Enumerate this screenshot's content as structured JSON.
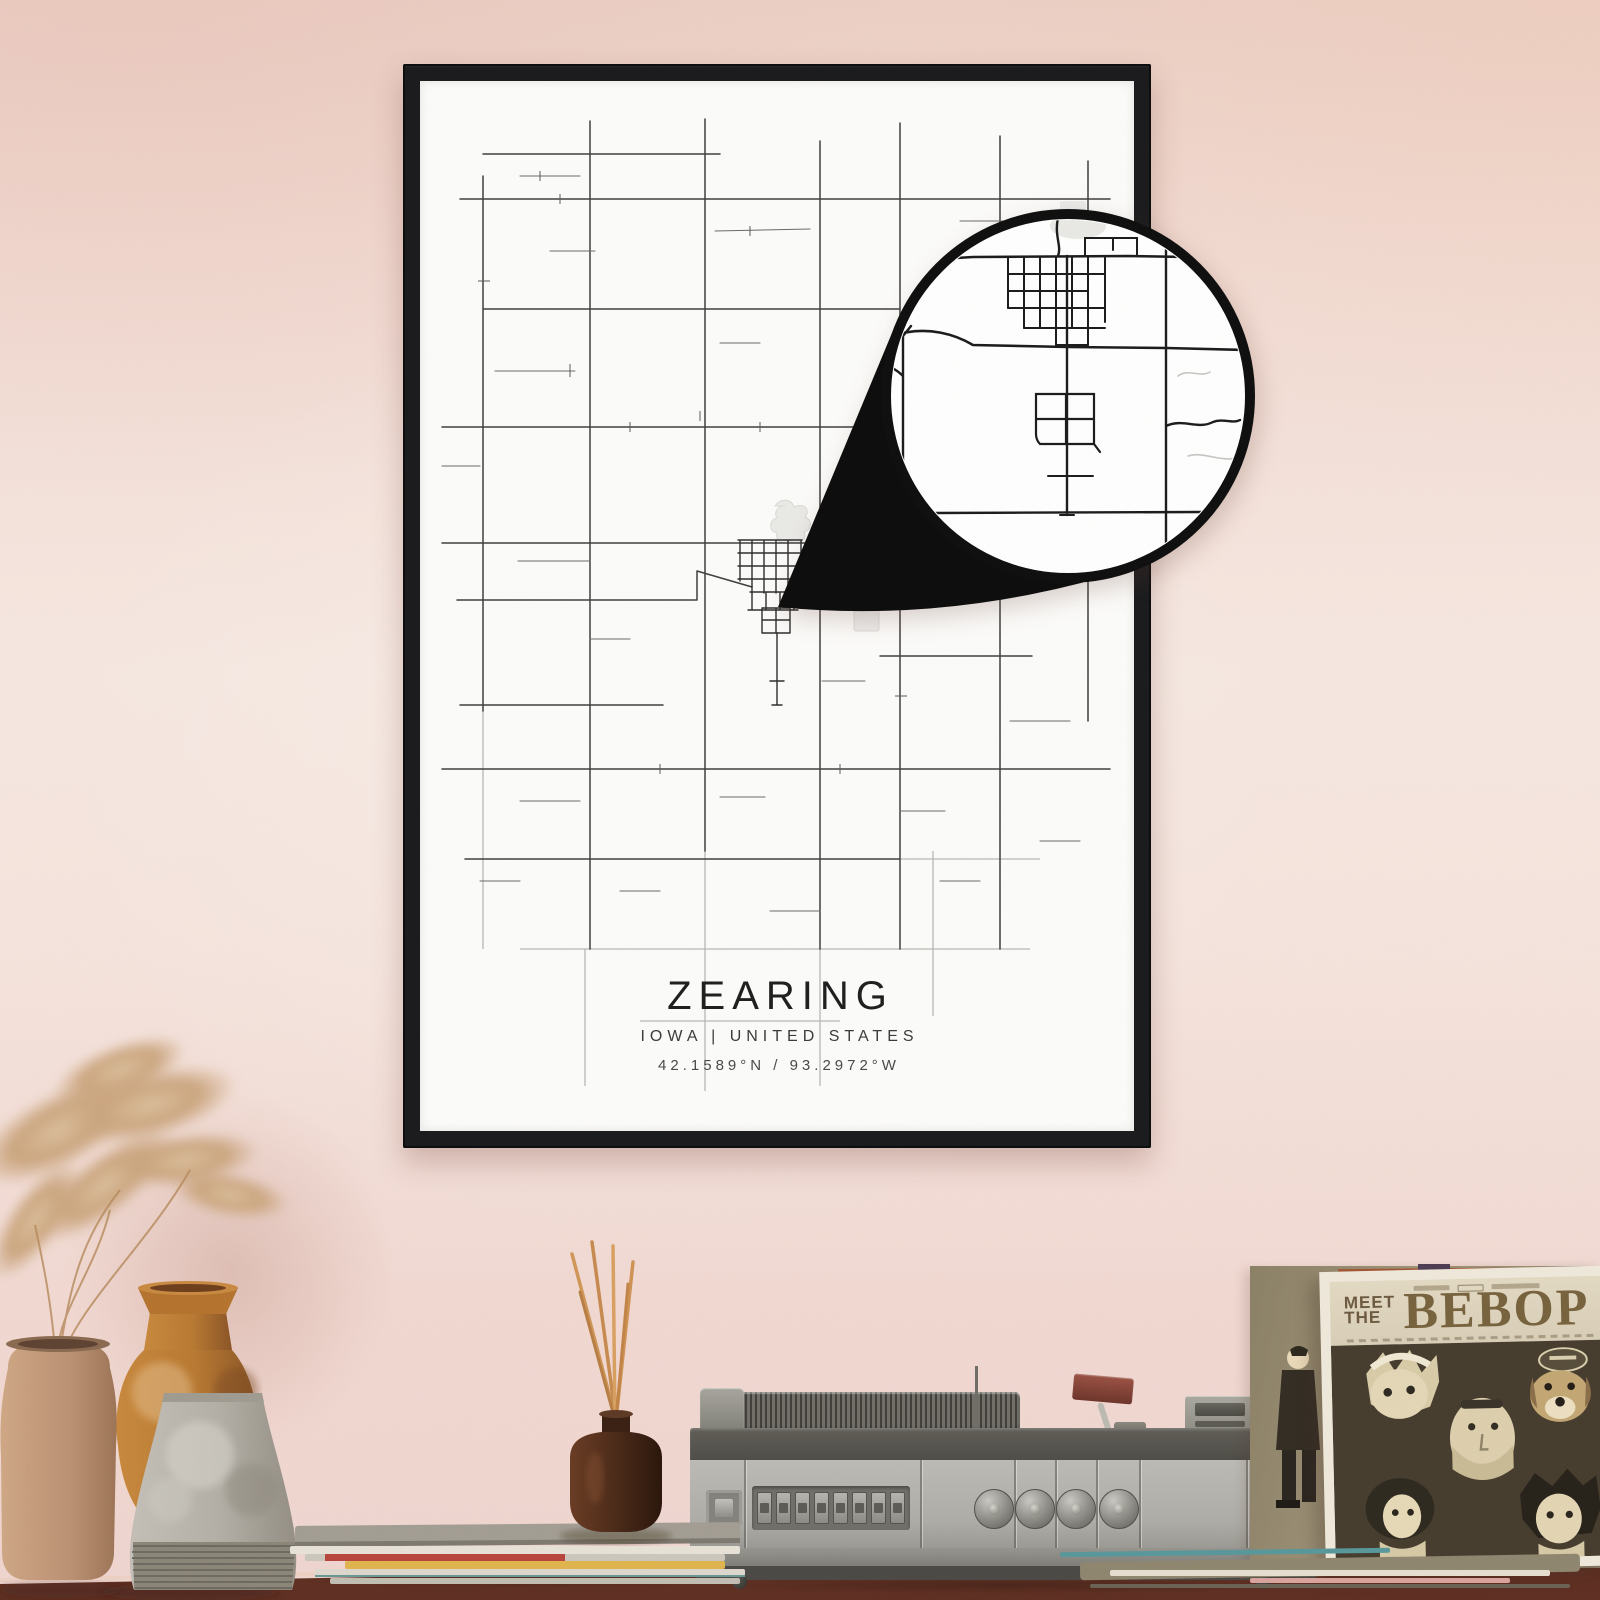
{
  "poster": {
    "city": "ZEARING",
    "region_line": "IOWA | UNITED STATES",
    "coordinates": "42.1589°N / 93.2972°W"
  },
  "album": {
    "meet": "MEET",
    "the": "THE",
    "title": "BEBOP"
  },
  "colors": {
    "wall_top": "#ecd0c6",
    "wall_mid": "#f6e8e1",
    "wall_bottom": "#efd5cf",
    "frame": "#1a1b1d",
    "poster_background": "#fcfcfa",
    "road_dark": "#3f3f3f",
    "road_light": "#b5b5b5",
    "loupe_ring": "#0f0f0f",
    "tabletop": "#7c4331",
    "album_sleeve": "#efe9db",
    "album_art_background": "#463d2f",
    "vase_tan": "#c7a183",
    "vase_amber": "#c8893e",
    "vase_gray": "#bcb8b0",
    "diffuser_bottle": "#4e2c1a",
    "reed_sticks": "#d09758"
  }
}
